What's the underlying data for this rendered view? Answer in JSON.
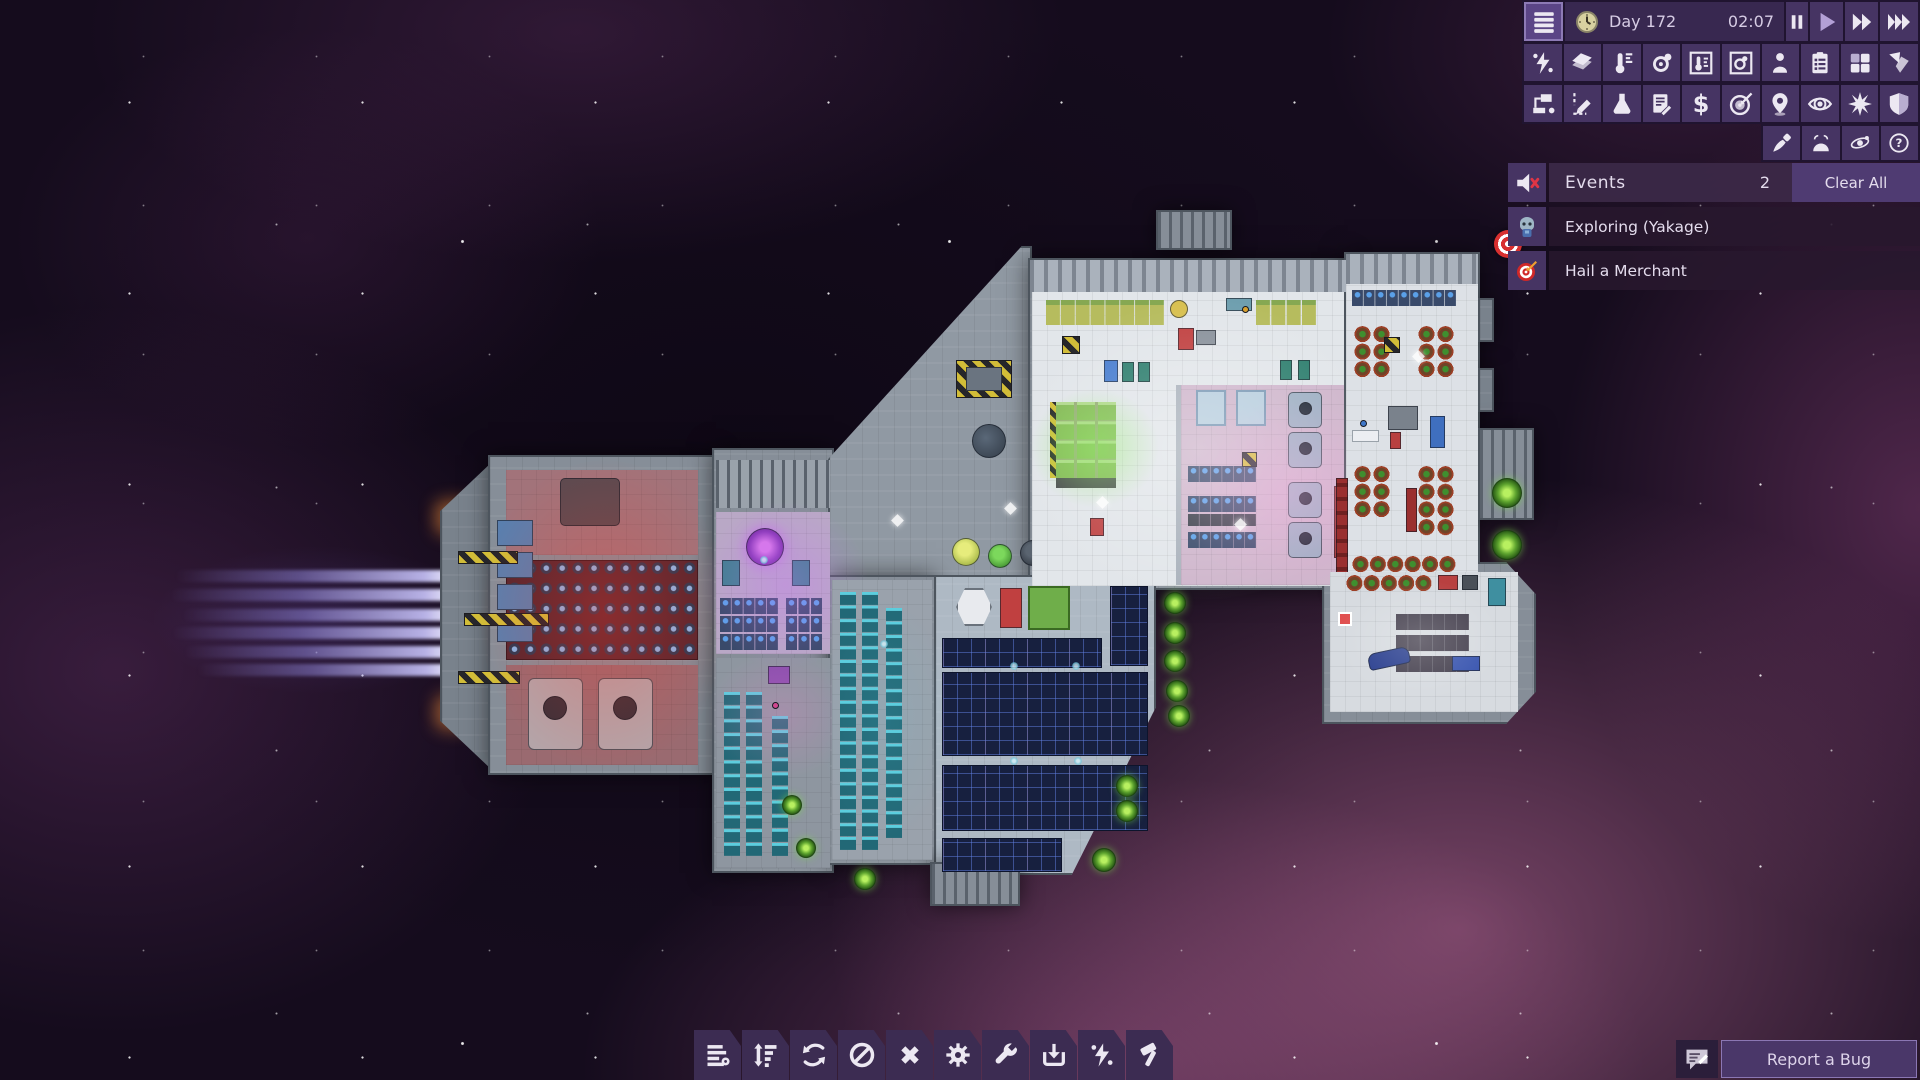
{
  "topbar": {
    "day": "Day 172",
    "time": "02:07",
    "menu_icon": "hamburger-icon",
    "clock_icon": "clock-icon",
    "speed_controls": [
      {
        "name": "pause",
        "icon": "pause-icon",
        "active": false
      },
      {
        "name": "play",
        "icon": "play-icon",
        "active": true
      },
      {
        "name": "fast-forward",
        "icon": "fast-forward-icon",
        "active": false
      },
      {
        "name": "fastest-forward",
        "icon": "fastest-forward-icon",
        "active": false
      }
    ]
  },
  "toolbar": {
    "row1": [
      "power-overlay-icon",
      "hull-tiles-icon",
      "temperature-icon",
      "gas-circulation-icon",
      "temperature-view-icon",
      "oxygen-view-icon",
      "crew-icon",
      "task-list-icon",
      "rooms-grid-icon",
      "shuttle-icon"
    ],
    "row2": [
      "logistics-nodes-icon",
      "draw-plan-icon",
      "research-flask-icon",
      "contracts-icon",
      "trade-dollar-icon",
      "missions-target-icon",
      "map-pin-icon",
      "visibility-eye-icon",
      "combat-burst-icon",
      "shield-icon"
    ],
    "row3": [
      "paint-brush-icon",
      "planet-scan-icon",
      "star-system-icon",
      "help-icon"
    ]
  },
  "events": {
    "mute_icon": "speaker-muted-icon",
    "title": "Events",
    "count": "2",
    "clear_all": "Clear All",
    "items": [
      {
        "icon": "explorer-portrait-icon",
        "label": "Exploring (Yakage)"
      },
      {
        "icon": "target-dart-icon",
        "label": "Hail a Merchant"
      }
    ]
  },
  "bottom_toolbar": [
    "work-queue-icon",
    "priorities-icon",
    "rotate-icon",
    "forbid-icon",
    "cancel-icon",
    "operate-gear-icon",
    "maintain-wrench-icon",
    "salvage-download-icon",
    "power-icon",
    "build-hammer-icon"
  ],
  "bug_report": {
    "icon": "feedback-bubble-icon",
    "label": "Report a Bug"
  },
  "colors": {
    "panel": "#463463",
    "panel_dark": "#201430",
    "panel_light": "#5b4586",
    "event_row": "rgba(40,24,46,.88)",
    "highlight": "#b3a0d6",
    "accent_text": "#d6cce4",
    "alert_red": "#e03545",
    "engine_trail": "#9b8fe0"
  }
}
